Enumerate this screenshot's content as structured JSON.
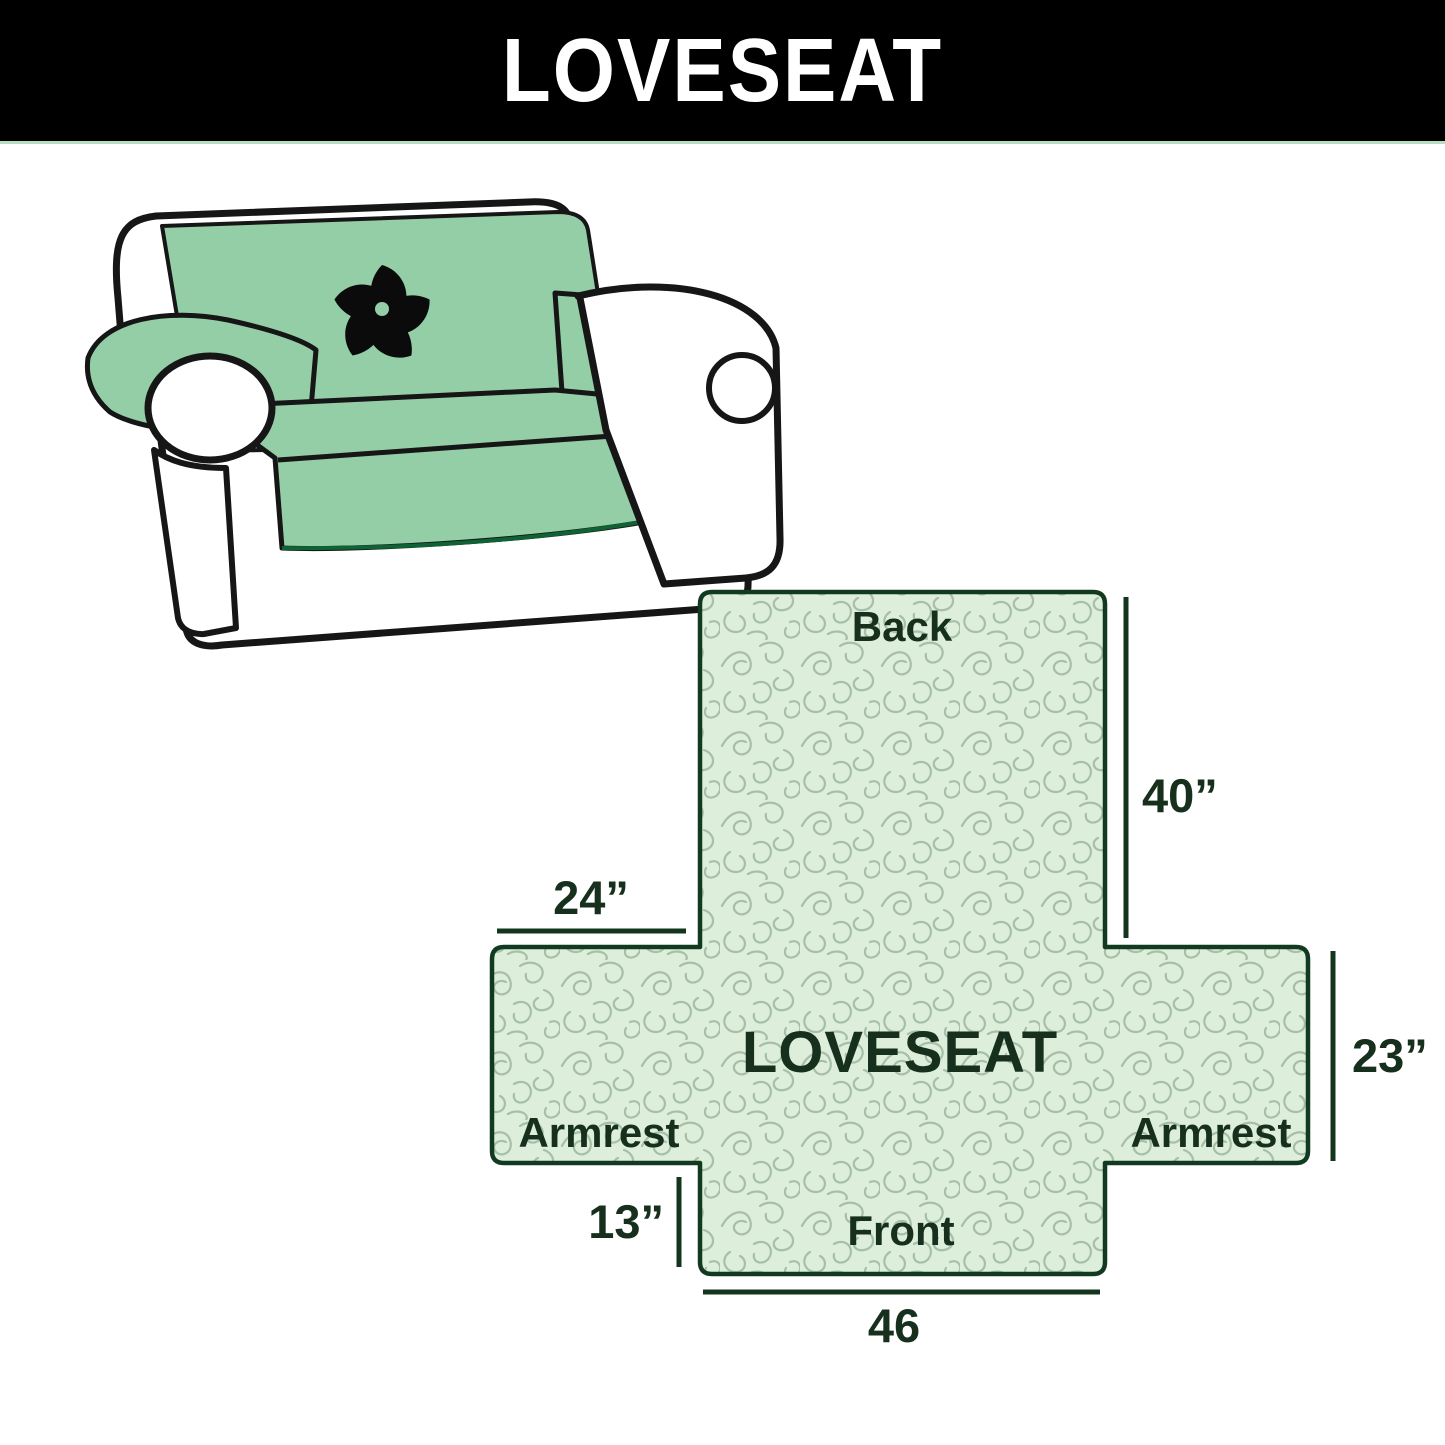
{
  "header": {
    "title": "LOVESEAT",
    "background_color": "#000000",
    "text_color": "#ffffff"
  },
  "illustration": {
    "description": "loveseat sofa draped with mint green protective cover",
    "logo_icon": "pinwheel-icon",
    "cover_color": "#94cea7",
    "cover_edge_color": "#0e6233",
    "outline_color": "#161616"
  },
  "diagram": {
    "center_label": "LOVESEAT",
    "fill_color": "#ddefdb",
    "pattern_line_color": "#a6bfa6",
    "outline_color": "#123a20",
    "text_color": "#17301e",
    "labels": {
      "back": "Back",
      "front": "Front",
      "armrest_left": "Armrest",
      "armrest_right": "Armrest"
    },
    "dimensions": {
      "back_length": "40”",
      "armrest_length": "24”",
      "armrest_width": "23”",
      "front_skirt": "13”",
      "front_width": "46"
    }
  }
}
